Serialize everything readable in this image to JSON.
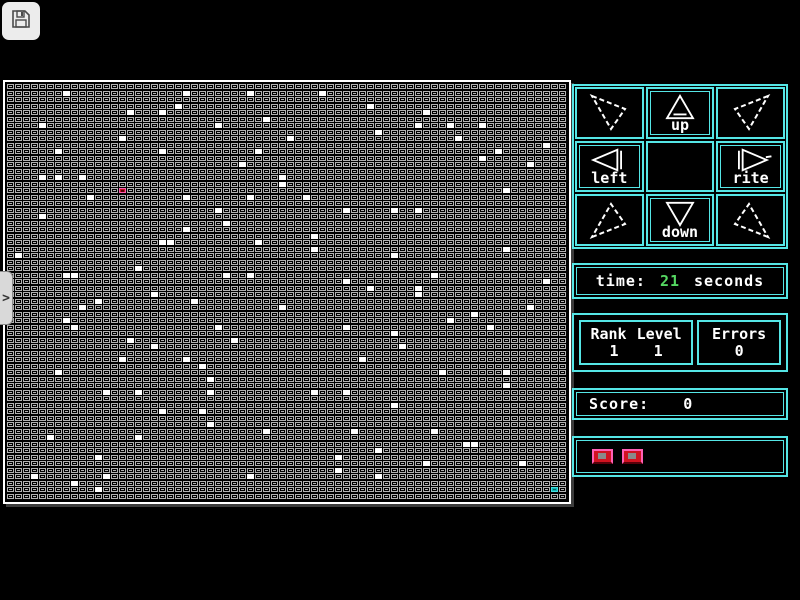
{
  "colors": {
    "cyan": "#55e6e6",
    "green": "#55d862",
    "tile_gray": "#b2b2b2",
    "lit_white": "#ffffff",
    "cursor_red": "#c21320",
    "cursor_pink": "#ff5fb4",
    "exit_teal": "#0fb0b0"
  },
  "toolbar": {
    "save_icon": "floppy-disk"
  },
  "side_tab": {
    "chevron": ">"
  },
  "controls": {
    "cells": [
      {
        "name": "up-left",
        "label": ""
      },
      {
        "name": "up",
        "label": "up"
      },
      {
        "name": "up-right",
        "label": ""
      },
      {
        "name": "left",
        "label": "left"
      },
      {
        "name": "center",
        "label": ""
      },
      {
        "name": "rite",
        "label": "rite"
      },
      {
        "name": "down-left",
        "label": ""
      },
      {
        "name": "down",
        "label": "down"
      },
      {
        "name": "down-right",
        "label": ""
      }
    ]
  },
  "time_panel": {
    "label": "time:",
    "value": "21",
    "unit": "seconds"
  },
  "stats_panel": {
    "rank_label": "Rank",
    "level_label": "Level",
    "rank_value": "1",
    "level_value": "1",
    "errors_label": "Errors",
    "errors_value": "0"
  },
  "score_panel": {
    "label": "Score:",
    "value": "0"
  },
  "button_panel": {
    "buttons": [
      "red-button-1",
      "red-button-2"
    ]
  },
  "grid": {
    "cols": 70,
    "rows": 64,
    "cursor": {
      "col": 14,
      "row": 16
    },
    "exit": {
      "col": 68,
      "row": 62
    },
    "lit_cells": [
      [
        7,
        1
      ],
      [
        22,
        1
      ],
      [
        30,
        1
      ],
      [
        39,
        1
      ],
      [
        21,
        3
      ],
      [
        45,
        3
      ],
      [
        15,
        4
      ],
      [
        19,
        4
      ],
      [
        52,
        4
      ],
      [
        32,
        5
      ],
      [
        4,
        6
      ],
      [
        26,
        6
      ],
      [
        51,
        6
      ],
      [
        55,
        6
      ],
      [
        59,
        6
      ],
      [
        46,
        7
      ],
      [
        14,
        8
      ],
      [
        35,
        8
      ],
      [
        56,
        8
      ],
      [
        67,
        9
      ],
      [
        6,
        10
      ],
      [
        19,
        10
      ],
      [
        31,
        10
      ],
      [
        61,
        10
      ],
      [
        59,
        11
      ],
      [
        29,
        12
      ],
      [
        65,
        12
      ],
      [
        4,
        14
      ],
      [
        6,
        14
      ],
      [
        9,
        14
      ],
      [
        34,
        14
      ],
      [
        34,
        15
      ],
      [
        62,
        16
      ],
      [
        10,
        17
      ],
      [
        22,
        17
      ],
      [
        30,
        17
      ],
      [
        37,
        17
      ],
      [
        26,
        19
      ],
      [
        42,
        19
      ],
      [
        48,
        19
      ],
      [
        51,
        19
      ],
      [
        4,
        20
      ],
      [
        27,
        21
      ],
      [
        22,
        22
      ],
      [
        38,
        23
      ],
      [
        19,
        24
      ],
      [
        20,
        24
      ],
      [
        31,
        24
      ],
      [
        38,
        25
      ],
      [
        62,
        25
      ],
      [
        1,
        26
      ],
      [
        48,
        26
      ],
      [
        16,
        28
      ],
      [
        7,
        29
      ],
      [
        8,
        29
      ],
      [
        27,
        29
      ],
      [
        30,
        29
      ],
      [
        53,
        29
      ],
      [
        42,
        30
      ],
      [
        67,
        30
      ],
      [
        45,
        31
      ],
      [
        51,
        31
      ],
      [
        18,
        32
      ],
      [
        51,
        32
      ],
      [
        11,
        33
      ],
      [
        23,
        33
      ],
      [
        9,
        34
      ],
      [
        34,
        34
      ],
      [
        65,
        34
      ],
      [
        58,
        35
      ],
      [
        7,
        36
      ],
      [
        55,
        36
      ],
      [
        8,
        37
      ],
      [
        26,
        37
      ],
      [
        42,
        37
      ],
      [
        60,
        37
      ],
      [
        48,
        38
      ],
      [
        15,
        39
      ],
      [
        28,
        39
      ],
      [
        18,
        40
      ],
      [
        49,
        40
      ],
      [
        14,
        42
      ],
      [
        22,
        42
      ],
      [
        44,
        42
      ],
      [
        24,
        43
      ],
      [
        6,
        44
      ],
      [
        54,
        44
      ],
      [
        62,
        44
      ],
      [
        25,
        45
      ],
      [
        62,
        46
      ],
      [
        12,
        47
      ],
      [
        16,
        47
      ],
      [
        25,
        47
      ],
      [
        38,
        47
      ],
      [
        42,
        47
      ],
      [
        48,
        49
      ],
      [
        19,
        50
      ],
      [
        24,
        50
      ],
      [
        25,
        52
      ],
      [
        32,
        53
      ],
      [
        43,
        53
      ],
      [
        53,
        53
      ],
      [
        5,
        54
      ],
      [
        16,
        54
      ],
      [
        57,
        55
      ],
      [
        58,
        55
      ],
      [
        46,
        56
      ],
      [
        11,
        57
      ],
      [
        41,
        57
      ],
      [
        52,
        58
      ],
      [
        64,
        58
      ],
      [
        41,
        59
      ],
      [
        3,
        60
      ],
      [
        12,
        60
      ],
      [
        30,
        60
      ],
      [
        46,
        60
      ],
      [
        8,
        61
      ],
      [
        11,
        62
      ]
    ]
  }
}
